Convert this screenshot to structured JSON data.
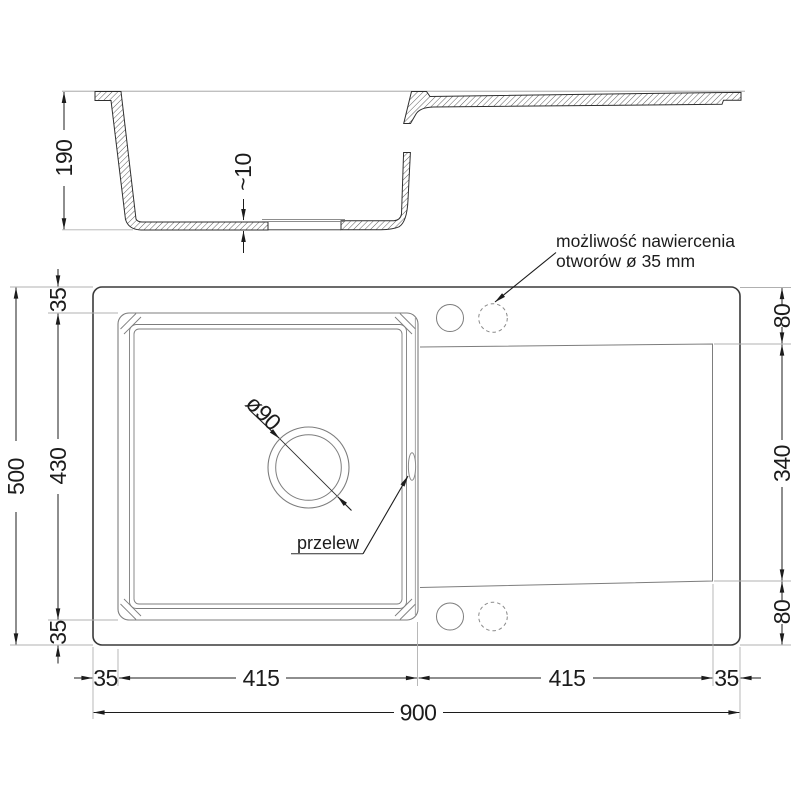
{
  "section": {
    "height": "190",
    "floor_thickness": "~10"
  },
  "plan": {
    "left": {
      "overall": "500",
      "rim_top": "35",
      "bowl_depth": "430",
      "rim_bottom": "35"
    },
    "right": {
      "rim_to_drainer": "80",
      "drainer_length": "340",
      "drainer_to_rim": "80"
    },
    "bottom": {
      "rim_left": "35",
      "bowl_width": "415",
      "drainer_width": "415",
      "rim_right": "35",
      "overall_width": "900"
    },
    "drain": {
      "diameter": "ø90"
    },
    "overflow": {
      "label": "przelew"
    },
    "holes_note": {
      "line1": "możliwość nawiercenia",
      "line2": "otworów ø 35 mm"
    }
  },
  "colors": {
    "background": "#ffffff",
    "object_line": "#2f2f2f",
    "detail_line": "#7d7d7d",
    "extension_line": "#b0b0b0",
    "dimension": "#1c1c1c"
  }
}
